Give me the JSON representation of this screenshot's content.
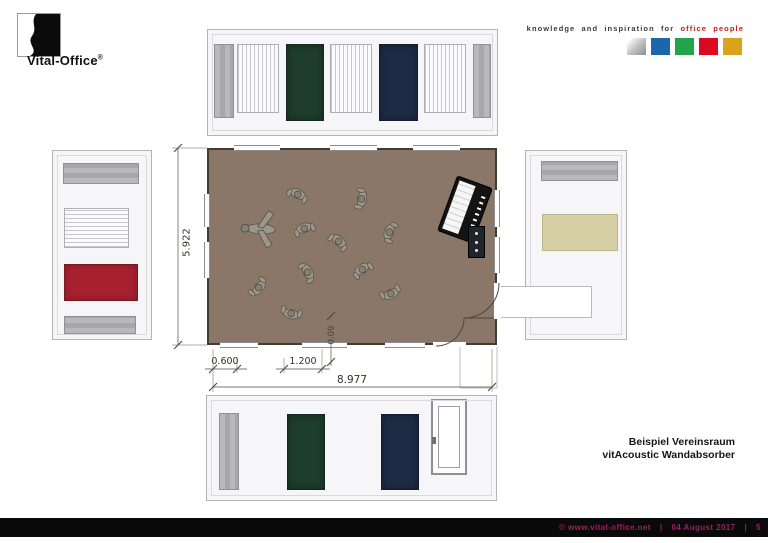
{
  "header": {
    "brand": "Vital-Office",
    "brand_registered": "®",
    "tagline_prefix": "knowledge and inspiration for",
    "tagline_highlight": "office people"
  },
  "drawing": {
    "dimensions": {
      "room_width": "8.977",
      "room_depth": "5.922",
      "absorber_offset": "0.600",
      "absorber_width": "1.200",
      "absorber_thickness": "0.09"
    },
    "people": [
      {
        "x": 298,
        "y": 194,
        "r": 25,
        "v": "n"
      },
      {
        "x": 362,
        "y": 199,
        "r": 100,
        "v": "n"
      },
      {
        "x": 261,
        "y": 229,
        "r": 3,
        "v": "spread",
        "s": 1.1
      },
      {
        "x": 304,
        "y": 228,
        "r": -20,
        "v": "n"
      },
      {
        "x": 339,
        "y": 241,
        "r": 40,
        "v": "n"
      },
      {
        "x": 389,
        "y": 232,
        "r": -70,
        "v": "n"
      },
      {
        "x": 308,
        "y": 272,
        "r": 60,
        "v": "n"
      },
      {
        "x": 362,
        "y": 269,
        "r": -35,
        "v": "n"
      },
      {
        "x": 259,
        "y": 288,
        "r": 130,
        "v": "n"
      },
      {
        "x": 291,
        "y": 314,
        "r": 195,
        "v": "n"
      },
      {
        "x": 391,
        "y": 294,
        "r": 155,
        "v": "n"
      }
    ]
  },
  "title_block": {
    "line1": "Beispiel Vereinsraum",
    "line2": "vitAcoustic Wandabsorber"
  },
  "footer": {
    "copyright": "©  www.vital-office.net",
    "sep1": "|",
    "date": "04 August 2017",
    "sep2": "|",
    "page_number": "5"
  },
  "palette": {
    "floor_brown": "#8a7767",
    "wall_line": "#403d34",
    "panel_green": "#1e3d2c",
    "panel_navy": "#1d2b45",
    "panel_red": "#a8212f",
    "panel_beige": "#d6cea5",
    "square_blue": "#1b67ad",
    "square_green": "#23a34a",
    "square_red": "#dc0a1e",
    "square_gold": "#d9a41c",
    "tagline_red": "#bf1e18",
    "footer_text": "#9b1f64",
    "footer_bar": "#0a0a0a"
  }
}
